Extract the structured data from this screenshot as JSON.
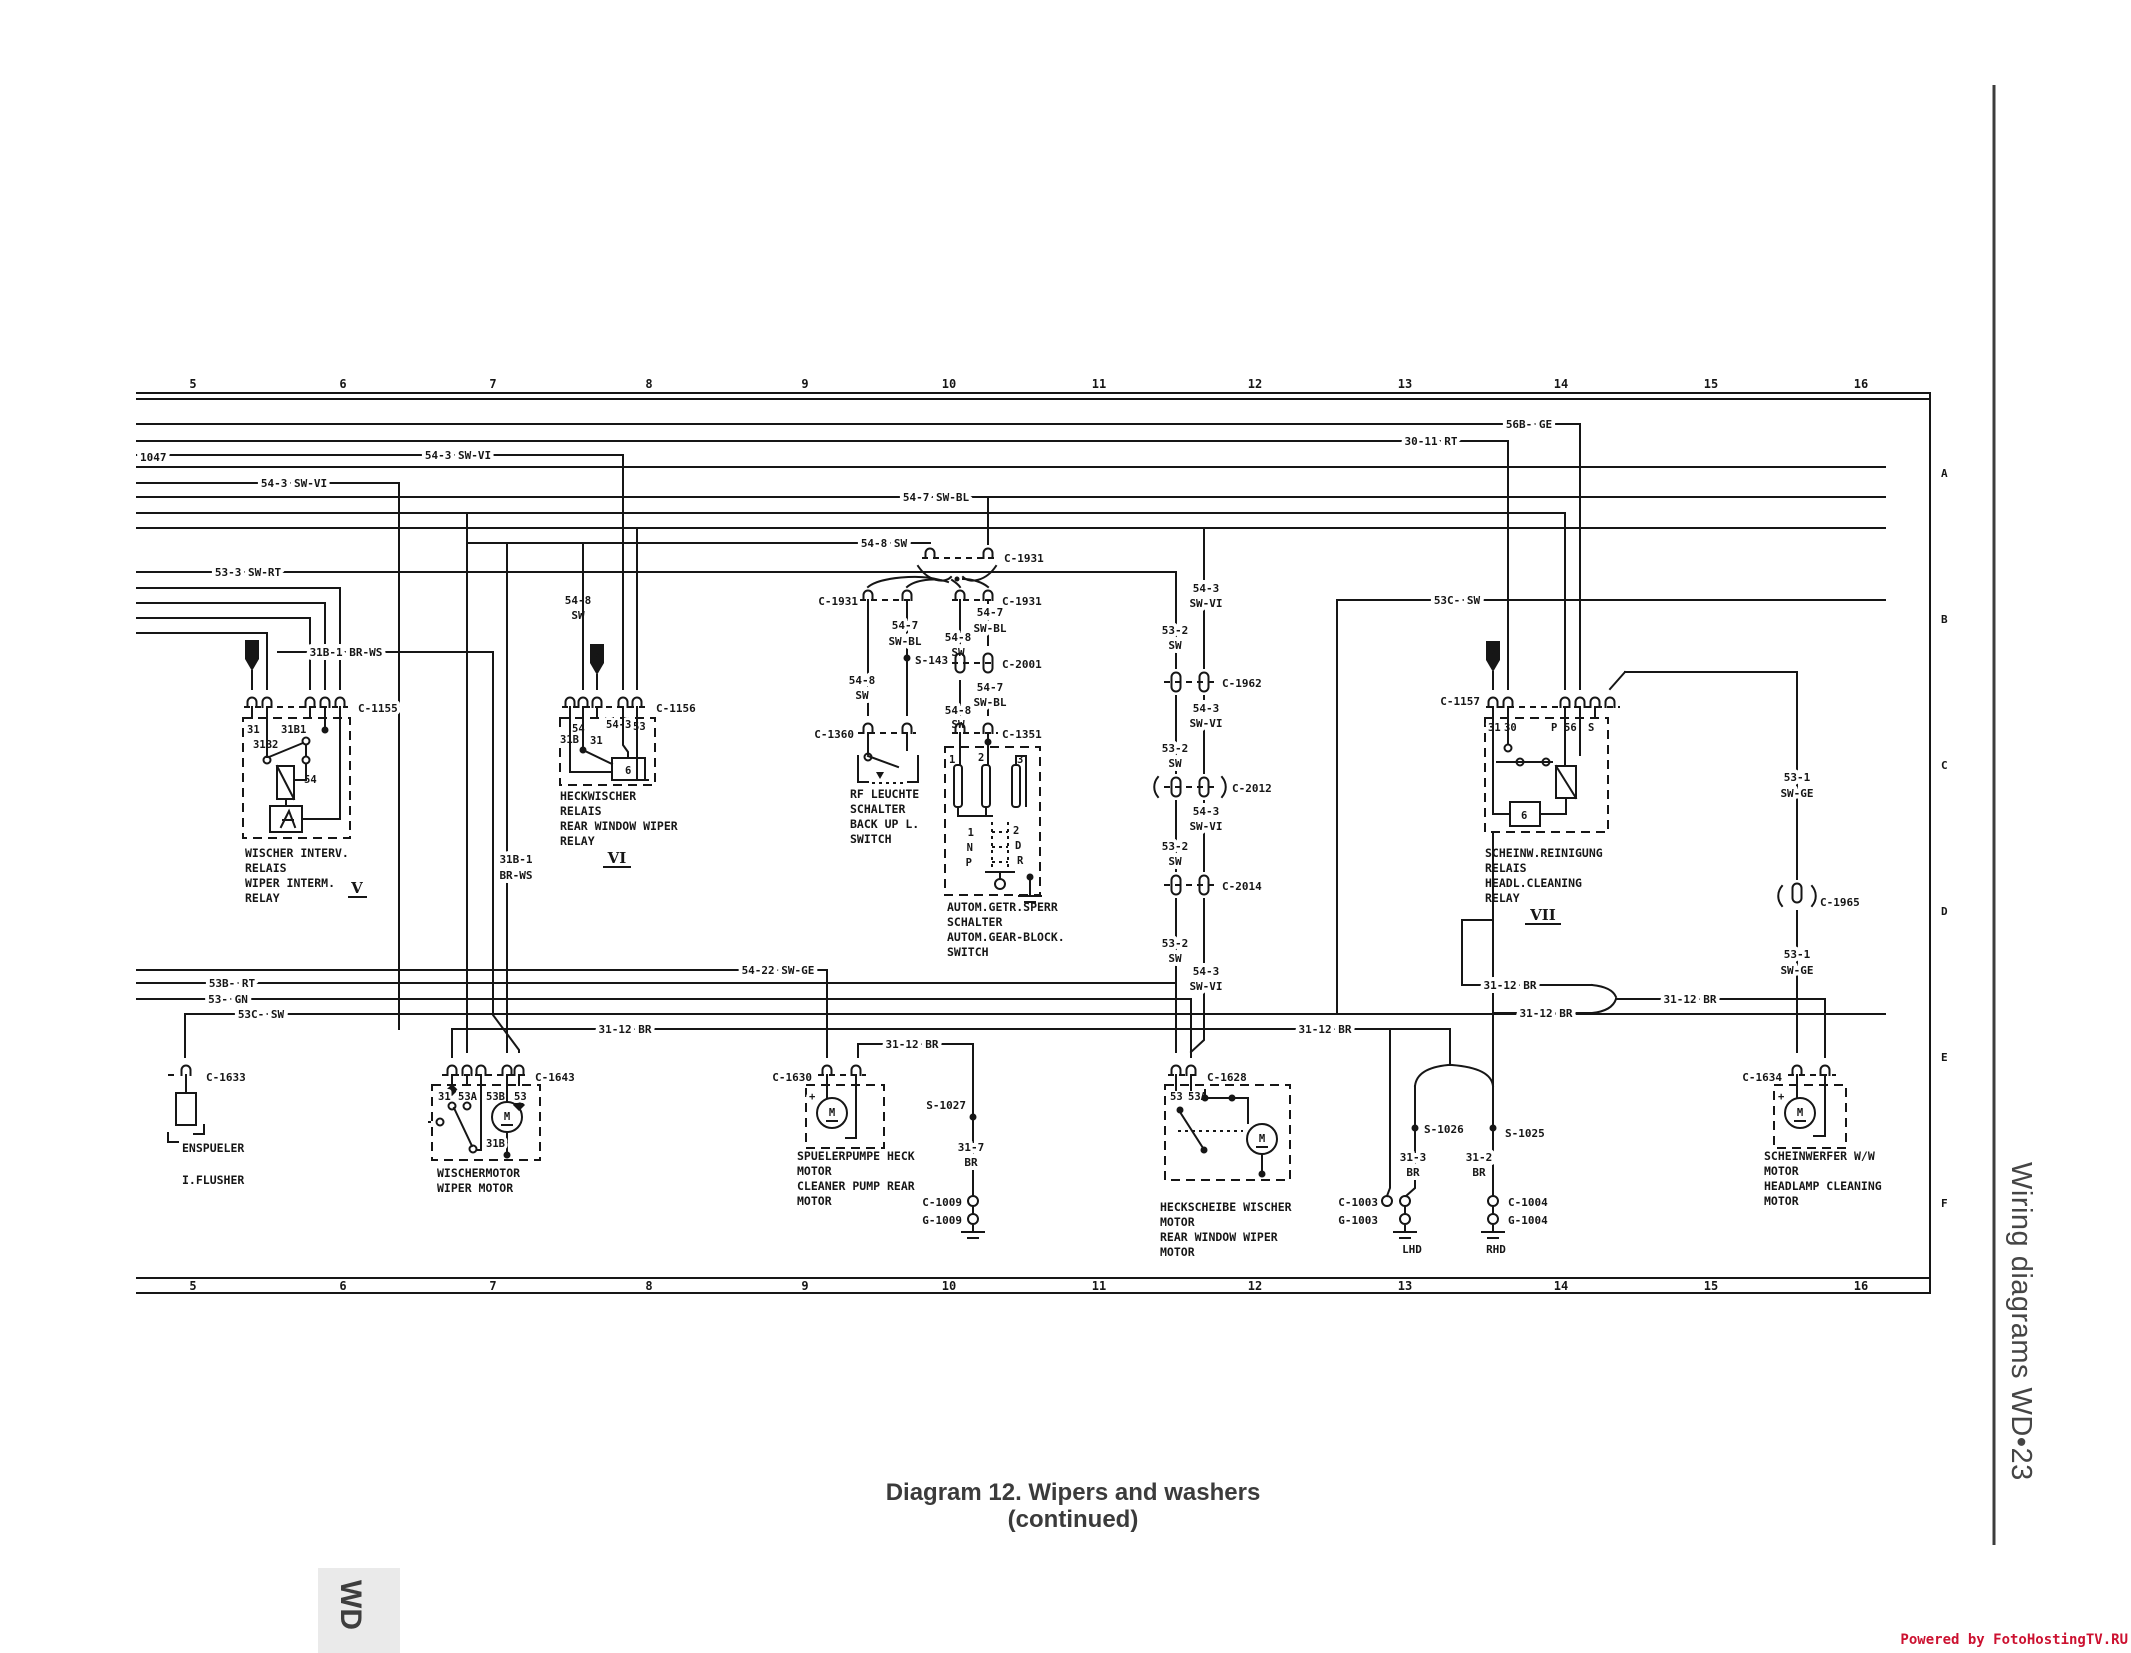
{
  "page": {
    "caption1": "Diagram 12. Wipers and washers",
    "caption2": "(continued)",
    "side": "Wiring diagrams  WD•23",
    "tab": "WD",
    "footer": "Powered by FotoHostingTV.RU",
    "ink": "#161616",
    "accent": "#cc1130"
  },
  "grid": {
    "top": [
      "5",
      "6",
      "7",
      "8",
      "9",
      "10",
      "11",
      "12",
      "13",
      "14",
      "15",
      "16"
    ],
    "bottom": [
      "5",
      "6",
      "7",
      "8",
      "9",
      "10",
      "11",
      "12",
      "13",
      "14",
      "15",
      "16"
    ],
    "rows": [
      "A",
      "B",
      "C",
      "D",
      "E",
      "F"
    ]
  },
  "sym": {
    "fuse": "2",
    "motor": "M"
  },
  "wire": {
    "w56b": "56B- GE",
    "w3011": "30-11 RT",
    "w543": "54-3 SW-VI",
    "n1047": "1047",
    "w547": "54-7 SW-BL",
    "w548": "54-8 SW",
    "w533": "53-3 SW-RT",
    "w31b1": "31B-1 BR-WS",
    "w53c": "53C- SW",
    "w53b": "53B- RT",
    "w53gn": "53- GN",
    "w5422": "54-22 SW-GE",
    "w3112": "31-12 BR",
    "p532": [
      "53-2",
      "SW"
    ],
    "p543": [
      "54-3",
      "SW-VI"
    ],
    "p547": [
      "54-7",
      "SW-BL"
    ],
    "p548": [
      "54-8",
      "SW"
    ],
    "p531": [
      "53-1",
      "SW-GE"
    ],
    "p313": [
      "31-3",
      "BR"
    ],
    "p312": [
      "31-2",
      "BR"
    ],
    "p317": [
      "31-7",
      "BR"
    ],
    "p31b1": [
      "31B-1",
      "BR-WS"
    ]
  },
  "conn": {
    "c1155": "C-1155",
    "c1156": "C-1156",
    "c1157": "C-1157",
    "c1931": "C-1931",
    "c2001": "C-2001",
    "c1360": "C-1360",
    "c1351": "C-1351",
    "c1962": "C-1962",
    "c2012": "C-2012",
    "c2014": "C-2014",
    "c1965": "C-1965",
    "c1633": "C-1633",
    "c1643": "C-1643",
    "c1630": "C-1630",
    "c1628": "C-1628",
    "c1634": "C-1634",
    "c1009": "C-1009",
    "g1009": "G-1009",
    "c1003": "C-1003",
    "g1003": "G-1003",
    "c1004": "C-1004",
    "g1004": "G-1004",
    "s143": "S-143",
    "s1027": "S-1027",
    "s1026": "S-1026",
    "s1025": "S-1025"
  },
  "comp": {
    "relay5": {
      "t31": "31",
      "t31b1": "31B1",
      "t31b2": "31B2",
      "t54": "54",
      "name": [
        "WISCHER INTERV.",
        "RELAIS",
        "WIPER INTERM.",
        "RELAY"
      ],
      "roman": "V"
    },
    "relay6": {
      "t31b": "31B",
      "t31": "31",
      "t54": "54",
      "t543": "54-3",
      "t53": "53",
      "coil": "6",
      "name": [
        "HECKWISCHER",
        "RELAIS",
        "REAR WINDOW WIPER",
        "RELAY"
      ],
      "roman": "VI"
    },
    "relay7": {
      "t31": "31",
      "t30": "30",
      "tp": "P",
      "t56": "56",
      "ts": "S",
      "coil": "6",
      "name": [
        "SCHEINW.REINIGUNG",
        "RELAIS",
        "HEADL.CLEANING",
        "RELAY"
      ],
      "roman": "VII"
    },
    "backup": {
      "name": [
        "RF LEUCHTE",
        "SCHALTER",
        "BACK UP L.",
        "SWITCH"
      ]
    },
    "gear": {
      "p1": "1",
      "p2": "2",
      "p3": "3",
      "l1": "1",
      "ln": "N",
      "lp": "P",
      "r2": "2",
      "rd": "D",
      "rr": "R",
      "name": [
        "AUTOM.GETR.SPERR",
        "SCHALTER",
        "AUTOM.GEAR-BLOCK.",
        "SWITCH"
      ]
    },
    "flusher": {
      "name": [
        "ENSPUELER",
        "I.FLUSHER"
      ]
    },
    "wiper": {
      "t31": "31",
      "t53a": "53A",
      "t53b": "53B",
      "t53": "53",
      "t31b": "31B",
      "name": [
        "WISCHERMOTOR",
        "WIPER MOTOR"
      ]
    },
    "pump": {
      "plus": "+",
      "name": [
        "SPUELERPUMPE HECK",
        "MOTOR",
        "CLEANER PUMP REAR",
        "MOTOR"
      ]
    },
    "rear": {
      "t53": "53",
      "t53a": "53A",
      "name": [
        "HECKSCHEIBE WISCHER",
        "MOTOR",
        "REAR WINDOW WIPER",
        "MOTOR"
      ]
    },
    "head": {
      "plus": "+",
      "name": [
        "SCHEINWERFER W/W",
        "MOTOR",
        "HEADLAMP CLEANING",
        "MOTOR"
      ]
    },
    "lhd": "LHD",
    "rhd": "RHD"
  }
}
